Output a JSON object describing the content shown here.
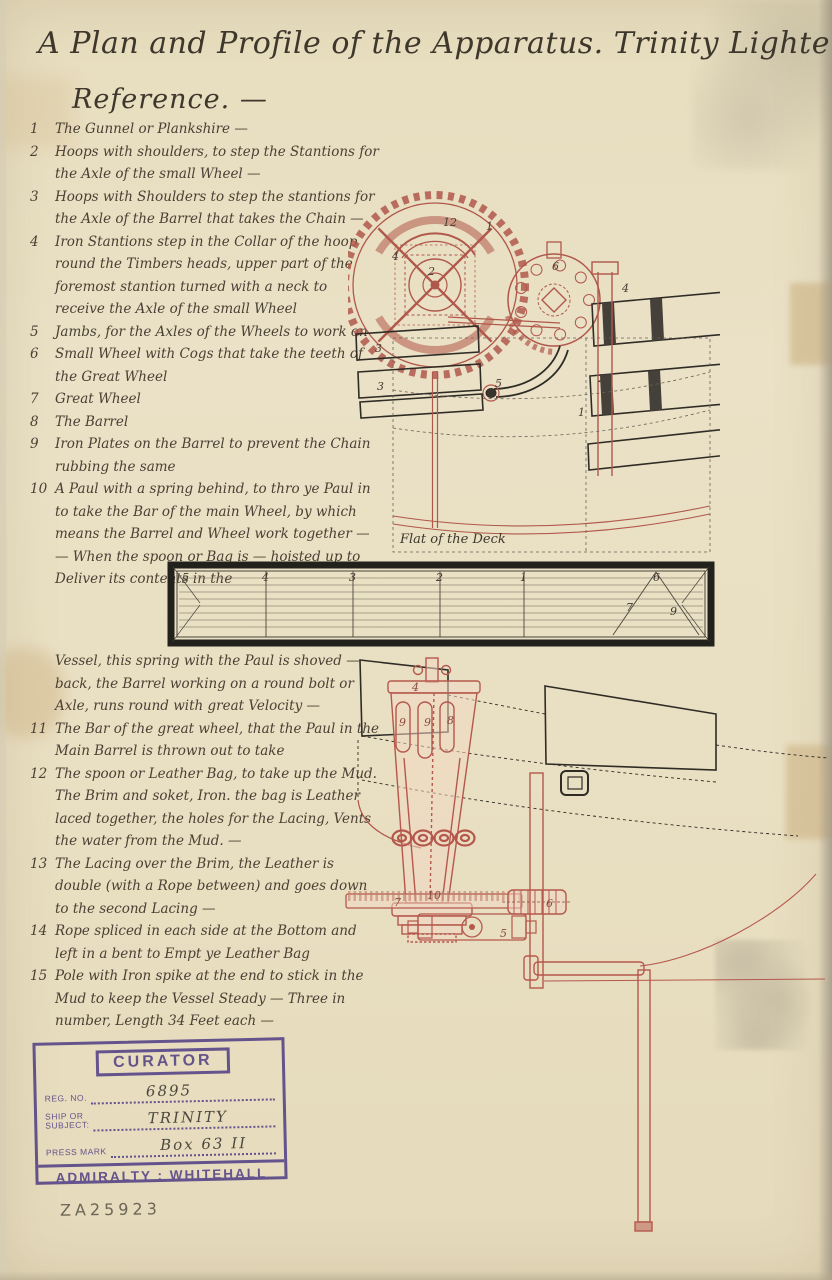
{
  "document": {
    "title": "A Plan and Profile of the Apparatus. Trinity Lighter Nº. 3 —",
    "heading": "Reference. —",
    "catalog_number": "ZA25923"
  },
  "reference": {
    "items_upper": [
      {
        "num": "1",
        "text": "The Gunnel or Plankshire —"
      },
      {
        "num": "2",
        "text": "Hoops with shoulders, to step the Stantions for the Axle of the small Wheel —"
      },
      {
        "num": "3",
        "text": "Hoops with Shoulders to step the stantions for the Axle of the Barrel that takes the Chain —"
      },
      {
        "num": "4",
        "text": "Iron Stantions step in the Collar of the hoop round the Timbers heads, upper part of the foremost stantion turned with a neck to receive the Axle of the small Wheel"
      },
      {
        "num": "5",
        "text": "Jambs, for the Axles of the Wheels to work on"
      },
      {
        "num": "6",
        "text": "Small Wheel with Cogs that take the teeth of the Great Wheel"
      },
      {
        "num": "7",
        "text": "Great Wheel"
      },
      {
        "num": "8",
        "text": "The Barrel"
      },
      {
        "num": "9",
        "text": "Iron Plates on the Barrel to prevent the Chain rubbing the same"
      },
      {
        "num": "10",
        "text": "A Paul with a spring behind, to thro ye Paul in to take the Bar of the main Wheel, by which means the Barrel and Wheel work together — — When the spoon or Bag is — hoisted up to Deliver its contents in the"
      }
    ],
    "continuation": "Vessel, this spring with the Paul is shoved — back, the Barrel working on a round bolt or Axle, runs round with great Velocity —",
    "items_lower": [
      {
        "num": "11",
        "text": "The Bar of the great wheel, that the Paul in the Main Barrel is thrown out to take"
      },
      {
        "num": "12",
        "text": "The spoon or Leather Bag, to take up the Mud. The Brim and soket, Iron. the bag is Leather laced together, the holes for the Lacing, Vents the water from the Mud. —"
      },
      {
        "num": "13",
        "text": "The Lacing over the Brim, the Leather is double (with a Rope between) and goes down to the second Lacing —"
      },
      {
        "num": "14",
        "text": "Rope spliced in each side at the Bottom and left in a bent to Empt ye Leather Bag"
      },
      {
        "num": "15",
        "text": "Pole with Iron spike at the end to stick in the Mud to keep the Vessel Steady — Three in number, Length 34 Feet each —"
      }
    ]
  },
  "plan_view": {
    "deck_label": "Flat of the Deck",
    "labels": {
      "n12": "12",
      "n1": "1",
      "n4a": "4",
      "n2hub": "2",
      "n6": "6",
      "n4b": "4",
      "n2a": "2",
      "n2b": "2",
      "n1b": "1",
      "n3a": "3",
      "n3b": "3",
      "n5": "5"
    }
  },
  "plan_strip": {
    "labels": [
      "5",
      "4",
      "3",
      "2",
      "1",
      "6",
      "7",
      "9"
    ]
  },
  "profile_view": {
    "labels": {
      "n4": "4",
      "n9a": "9",
      "n9b": "9",
      "n8": "8",
      "n10": "10",
      "n7": "7",
      "n6": "6",
      "n5": "5"
    }
  },
  "stamp": {
    "title": "CURATOR",
    "reg_no_label": "Reg. No.",
    "reg_no_value": "6895",
    "ship_label": "Ship or Subject:",
    "ship_value": "TRINITY",
    "press_mark_label": "Press Mark",
    "press_mark_value": "Box 63 II",
    "footer": "ADMIRALTY : WHITEHALL"
  },
  "colors": {
    "paper": "#e8dfc2",
    "red_ink": "#b0584b",
    "black_ink": "#2f2c26",
    "stamp_violet": "#5a4888",
    "pencil": "#6c6657"
  }
}
